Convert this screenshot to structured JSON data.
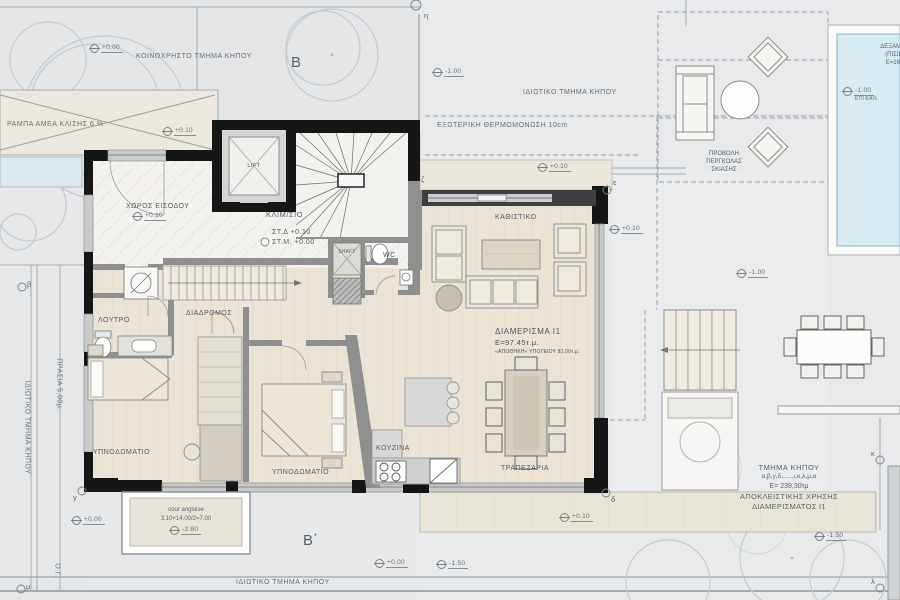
{
  "palette": {
    "garden_grey": "#e6e8e9",
    "floor_wood": "#ebe3d6",
    "marble": "#f4f2ef",
    "terrace_beige": "#e8e4d8",
    "wall_black": "#161616",
    "wall_grey": "#8f8f8f",
    "pool_blue": "#d8eaf2",
    "planter_blue": "#dce8ee",
    "line_grey": "#9aa0a5"
  },
  "sections": {
    "b": "B",
    "b_prime": "B΄"
  },
  "garden": {
    "common": "ΚΟΙΝΟΧΡΗΣΤΟ ΤΜΗΜΑ ΚΗΠΟΥ",
    "ramp": "ΡΑΜΠΑ ΑΜΕΑ ΚΛΙΣΗΣ 6 %",
    "private_top": "ΙΔΙΩΤΙΚΟ ΤΜΗΜΑ ΚΗΠΟΥ",
    "private_bottom": "ΙΔΙΩΤΙΚΟ ΤΜΗΜΑ ΚΗΠΟΥ",
    "private_left": "ΙΔΙΩΤΙΚΟ ΤΜΗΜΑ ΚΗΠΟΥ",
    "prasia": "ΠΡΑΣΙΑ 5,00μ.",
    "building_line": "Ο.Γ.",
    "insulation": "ΕΞΩΤΕΡΙΚΗ ΘΕΡΜΟΜΟΝΩΣΗ 10cm",
    "pergola_line1": "ΠΡΟΒΟΛΗ",
    "pergola_line2": "ΠΕΡΓΚΟΛΑΣ",
    "pergola_line3": "ΣΚΙΑΣΗΣ",
    "plot_line1": "ΤΜΗΜΑ ΚΗΠΟΥ",
    "plot_line2": "α,β,γ,δ,.....,ι,κ,λ,μ,α",
    "plot_line3": "E= 239,30τμ",
    "plot_line4": "ΑΠΟΚΛΕΙΣΤΙΚΗΣ ΧΡΗΣΗΣ",
    "plot_line5": "ΔΙΑΜΕΡΙΣΜΑΤΟΣ I1",
    "cour_line1": "cour anglaise",
    "cour_line2": "3.10×14.00/2=7.00"
  },
  "pool": {
    "line1": "ΔΕΞΑΜΕΝΗ",
    "line2": "(ΠΙΣΙΝΑ)",
    "line3": "E=16,80",
    "surface": "ΕΠΙΦΑΝ."
  },
  "apartment": {
    "name": "ΔΙΑΜΕΡΙΣΜΑ I1",
    "area": "E=97.45τ.μ.",
    "note": "«ΑΠΟΘΗΚΗ» ΥΠΟΓΕΙΟΥ 82,00τ.μ."
  },
  "rooms": {
    "entrance": "ΧΩΡΟΣ ΕΙΣΟΔΟΥ",
    "stairwell": "ΚΛΙΜ/ΣΙΟ",
    "stair_level_top": "ΣΤ.Δ +0.10",
    "stair_level_mid": "ΣΤ.Μ. +0.00",
    "lift": "LIFT",
    "shaft": "SHAFT",
    "wc": "WC",
    "corridor": "ΔΙΑΔΡΟΜΟΣ",
    "bathroom": "ΛΟΥΤΡΟ",
    "bedroom1": "ΥΠΝΟΔΩΜΑΤΙΟ",
    "bedroom2": "ΥΠΝΟΔΩΜΑΤΙΟ",
    "kitchen": "ΚΟΥΖΙΝΑ",
    "dining": "ΤΡΑΠΕΖΑΡΙΑ",
    "living": "ΚΑΘΙΣΤΙΚΟ"
  },
  "levels": {
    "tl_zero": "+0.00",
    "ramp_010": "+0.10",
    "garden_top_m100": "-1.00",
    "terrace_top_010": "+0.10",
    "entrance_010": "+0.10",
    "living_right_010": "+0.10",
    "garden_right_m100": "-1.00",
    "pool_m100": "-1.00",
    "terrace_bottom_010": "+0.10",
    "bottom_left_zero": "+0.00",
    "bottom_zero": "+0.00",
    "bottom_m150": "-1.50",
    "garden_bottom_m150": "-1.50",
    "cour_m280": "-2.80"
  },
  "boundary_points": {
    "eta": "η",
    "zeta": "ζ",
    "epsilon": "ε",
    "delta": "δ",
    "gamma": "γ",
    "beta": "β",
    "mu": "μ",
    "kappa": "κ",
    "lambda": "λ"
  }
}
